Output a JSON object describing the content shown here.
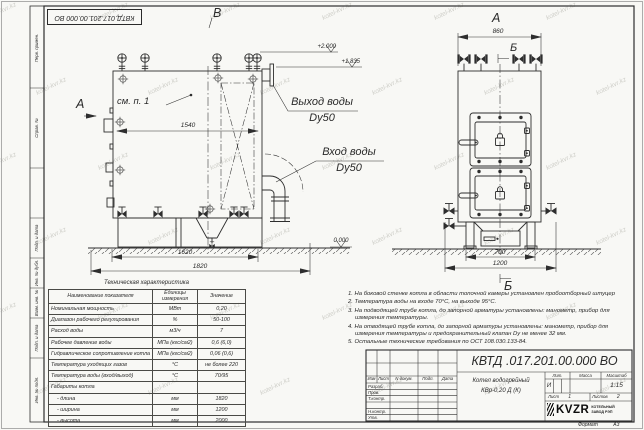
{
  "stamp_text": "КВТД.017.201.00.000 ВО",
  "watermark": {
    "text": "kotel-kvr.kz"
  },
  "frame_fields": [
    "Перв. примен.",
    "Справ. №",
    "Подп. и дата",
    "Инв. № дубл.",
    "Взам. инв. №",
    "Подп. и дата",
    "Инв. № подл."
  ],
  "views": {
    "front": {
      "label_v": "В",
      "label_a": "А",
      "see_note": "см. п. 1",
      "dim_inner": "1540",
      "dim_base": "1620",
      "dim_total": "1820",
      "elev_top": "+2.000",
      "elev_mid": "+1.835",
      "elev_zero": "0.000",
      "outlet_label": "Выход воды",
      "outlet_size": "Dy50",
      "inlet_label": "Вход воды",
      "inlet_size": "Dy50"
    },
    "side": {
      "label_a": "А",
      "label_b_top": "Б",
      "label_b_bottom": "Б",
      "dim_width": "860",
      "dim_base": "700",
      "dim_total": "1200"
    }
  },
  "tech_table": {
    "title": "Техническая характеристика",
    "headers": [
      "Наименование показателя",
      "Единицы измерения",
      "Значение"
    ],
    "rows": [
      [
        "Номинальная мощность",
        "МВт",
        "0,20"
      ],
      [
        "Диапазон рабочего регулирования",
        "%",
        "50-100"
      ],
      [
        "Расход воды",
        "м3/ч",
        "7"
      ],
      [
        "Рабочее давление воды",
        "МПа (кгс/см2)",
        "0,6 (6,0)"
      ],
      [
        "Гидравлическое сопротивление котла",
        "МПа (кгс/см2)",
        "0,06 (0,6)"
      ],
      [
        "Температура уходящих газов",
        "°С",
        "не более 220"
      ],
      [
        "Температура воды (вход/выход)",
        "°С",
        "70/95"
      ],
      [
        "Габариты котла",
        "",
        ""
      ],
      [
        "    - длина",
        "мм",
        "1820"
      ],
      [
        "    - ширина",
        "мм",
        "1200"
      ],
      [
        "    - высота",
        "мм",
        "2000"
      ]
    ]
  },
  "notes": [
    "1. На боковой стенке котла в области топочной камеры установлен пробоотборный штуцер",
    "2. Температура воды на входе 70°С, на выходе 95°С.",
    "3. На подводящей трубе котла, до запорной арматуры установлены: манометр, прибор для измерения температуры.",
    "4. На отводящей трубе котла, до запорной арматуры установлены: манометр, прибор для измерения температуры и предохранительный клапан Dу не менее 32 мм.",
    "5. Остальные технические требования по ОСТ 108.030.133-84."
  ],
  "title_block": {
    "doc_number": "КВТД .017.201.00.000  ВО",
    "rev_headers": [
      "Изм",
      "Лист",
      "N докум.",
      "Подп.",
      "Дата"
    ],
    "sig_rows": [
      "Разраб.",
      "Пров.",
      "Т.контр.",
      "",
      "Н.контр.",
      "Утв."
    ],
    "product_line1": "Котел водогрейный",
    "product_line2": "КВр-0,20 Д (К)",
    "lit_label": "Лит.",
    "mass_label": "Масса",
    "scale_label": "Масштаб",
    "lit_value": "И",
    "scale_value": "1:15",
    "sheet_label": "Лист",
    "sheet_value": "1",
    "sheets_label": "Листов",
    "sheets_value": "2",
    "logo_text": "KVZR",
    "company_line1": "КОТЕЛЬНЫЙ",
    "company_line2": "ЗАВОД РЭП",
    "format_label": "Формат",
    "format_value": "А3"
  }
}
